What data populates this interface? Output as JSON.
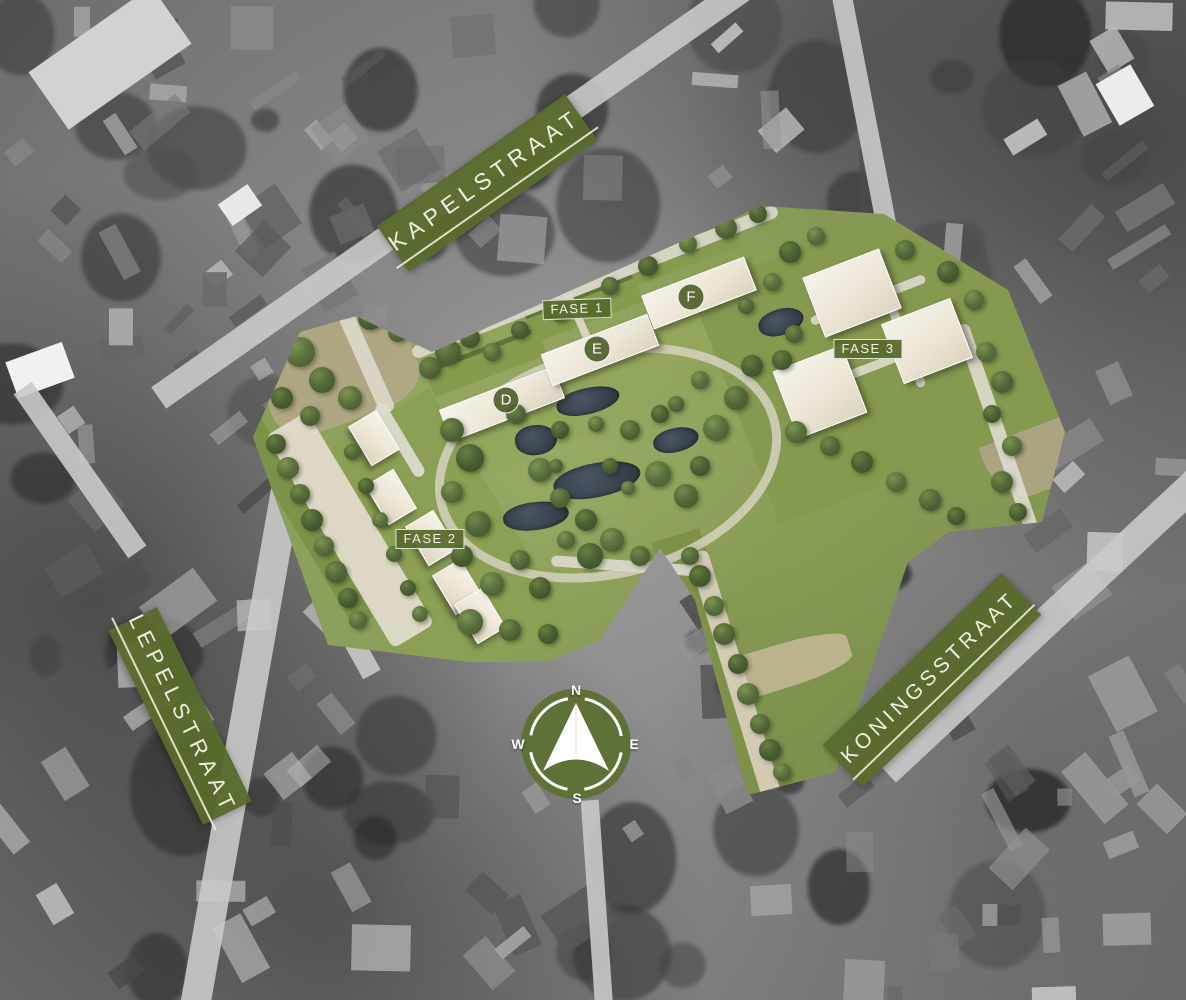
{
  "map": {
    "kind": "residential masterplan site plan over grayscale aerial photo",
    "streets": {
      "kapelstraat": "KAPELSTRAAT",
      "lepelstraat": "LEPELSTRAAT",
      "koningsstraat": "KONINGSSTRAAT"
    },
    "phases": [
      {
        "label": "FASE 1"
      },
      {
        "label": "FASE 2"
      },
      {
        "label": "FASE 3"
      }
    ],
    "building_markers": [
      {
        "label": "D"
      },
      {
        "label": "E"
      },
      {
        "label": "F"
      }
    ],
    "compass": {
      "north": "N",
      "east": "E",
      "south": "S",
      "west": "W"
    },
    "colors": {
      "banner_green": "#586a2d",
      "label_text_cream": "#eef0dd",
      "overlay_lawn_green": "#81954e",
      "water_dark": "#39424e",
      "building_beige": "#ece6d6",
      "path_light": "#dcd8ca"
    }
  }
}
